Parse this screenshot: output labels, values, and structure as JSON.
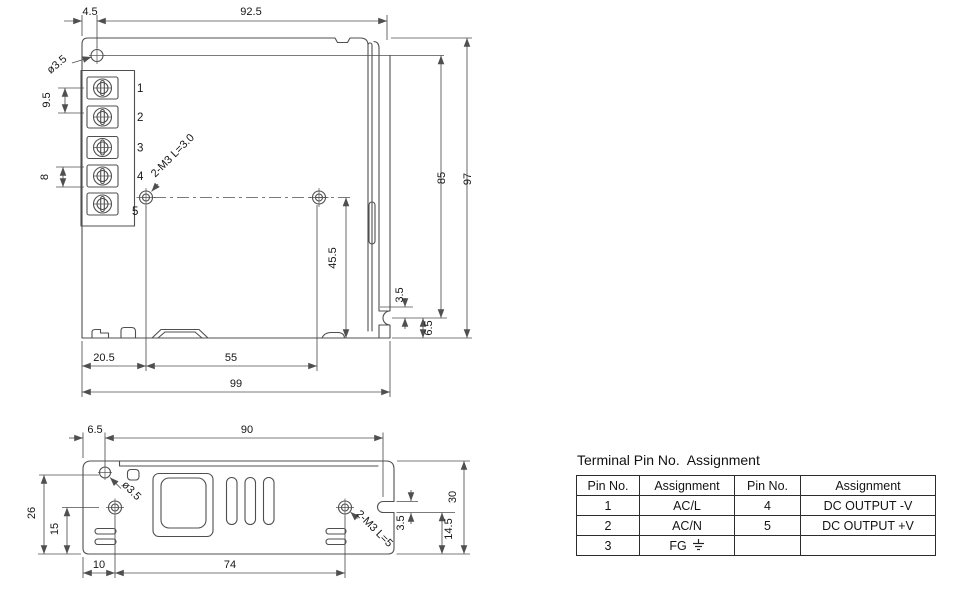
{
  "colors": {
    "line": "#4f4f4f",
    "text": "#161616",
    "background": "#ffffff"
  },
  "front_view": {
    "pin_labels": [
      "1",
      "2",
      "3",
      "4",
      "5"
    ],
    "dims": {
      "edge_to_hole": "4.5",
      "hole_to_right": "92.5",
      "hole_dia": "ø3.5",
      "pitch_upper": "9.5",
      "pitch_lower": "8",
      "screw_note": "2-M3 L=3.0",
      "hole_height": "45.5",
      "inner_height": "85",
      "total_height": "97",
      "notch_gap": "3.5",
      "notch_to_bottom": "6.5",
      "left_to_hole": "20.5",
      "hole_span": "55",
      "total_width": "99"
    }
  },
  "bottom_view": {
    "dims": {
      "edge_to_hole": "6.5",
      "hole_to_notch": "90",
      "hole_dia": "ø3.5",
      "hole_height": "26",
      "screw_height": "15",
      "screw_note": "2-M3 L=5",
      "notch_height": "3.5",
      "notch_to_bottom": "14.5",
      "total_height": "30",
      "left_to_screw": "10",
      "screw_span": "74"
    }
  },
  "pin_table": {
    "title": "Terminal Pin No.  Assignment",
    "headers": [
      "Pin No.",
      "Assignment",
      "Pin No.",
      "Assignment"
    ],
    "rows": [
      [
        "1",
        "AC/L",
        "4",
        "DC OUTPUT -V"
      ],
      [
        "2",
        "AC/N",
        "5",
        "DC OUTPUT +V"
      ],
      [
        "3",
        "FG",
        "",
        ""
      ]
    ]
  }
}
